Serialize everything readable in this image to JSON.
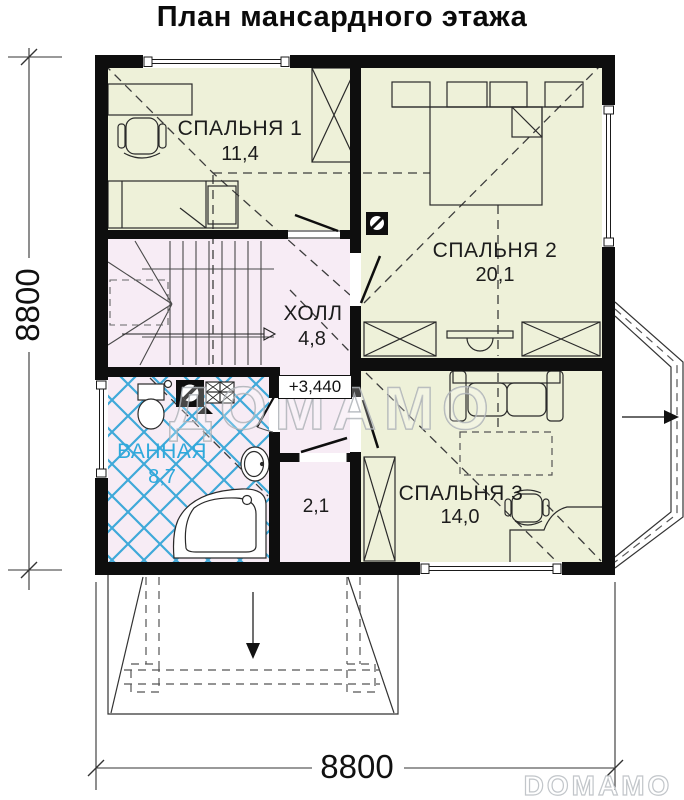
{
  "title": "План мансардного этажа",
  "rooms": {
    "bedroom1": {
      "label": "СПАЛЬНЯ 1",
      "area": "11,4"
    },
    "bedroom2": {
      "label": "СПАЛЬНЯ 2",
      "area": "20,1"
    },
    "bedroom3": {
      "label": "СПАЛЬНЯ 3",
      "area": "14,0"
    },
    "hall": {
      "label": "ХОЛЛ",
      "area": "4,8"
    },
    "bathroom": {
      "label": "ВАННАЯ",
      "area": "8,7"
    },
    "closet": {
      "area": "2,1"
    }
  },
  "annotations": {
    "level_mark": "+3,440"
  },
  "dimensions": {
    "left": "8800",
    "bottom": "8800"
  },
  "watermark": {
    "center": "ДОМАМО",
    "corner": "DOMAMO"
  },
  "colors": {
    "room_yellow": "#eef1d9",
    "room_pink": "#f7ecf5",
    "wall": "#0e0e0e",
    "tile_blue": "#3fa9d9",
    "bath_label": "#2fa9dc"
  }
}
